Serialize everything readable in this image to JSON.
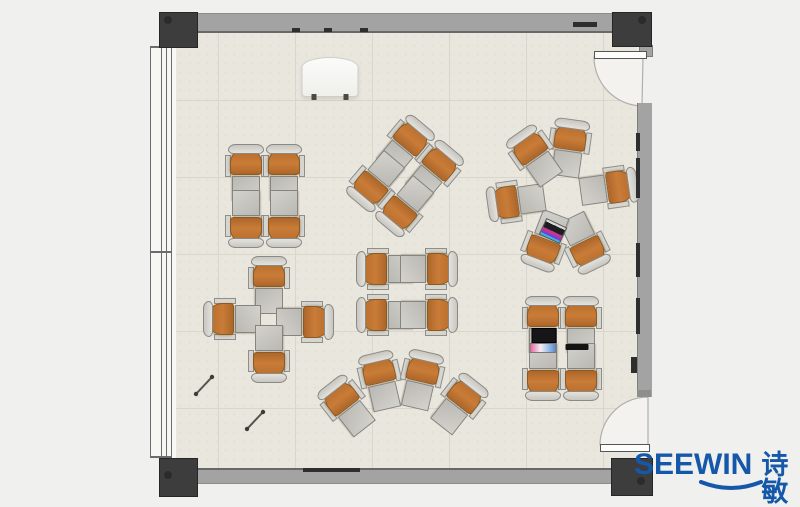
{
  "brand": {
    "name_en": "SEEWIN",
    "name_cn": "诗敏",
    "color": "#1557a8"
  },
  "plan": {
    "description": "classroom-floor-plan-top-view",
    "colors": {
      "background": "#f0f0ef",
      "floor": "#e9e6dd",
      "grid": "#d9d6cb",
      "wall": "#a3a3a3",
      "column": "#3d3d3d",
      "chair_seat": "#c97c38",
      "desk_top": "#c6c5c0",
      "brand": "#1557a8"
    },
    "furniture": {
      "unit_count": 30,
      "clusters": [
        {
          "name": "quad-top-left",
          "units": [
            {
              "x": 246,
              "y": 173,
              "rot": 180
            },
            {
              "x": 284,
              "y": 173,
              "rot": 180
            },
            {
              "x": 246,
              "y": 219,
              "rot": 0
            },
            {
              "x": 284,
              "y": 219,
              "rot": 0
            }
          ]
        },
        {
          "name": "quad-rotated-mid",
          "units": [
            {
              "x": 405,
              "y": 146,
              "rot": 220
            },
            {
              "x": 434,
              "y": 171,
              "rot": 220
            },
            {
              "x": 376,
              "y": 181,
              "rot": 40
            },
            {
              "x": 405,
              "y": 206,
              "rot": 40
            }
          ]
        },
        {
          "name": "circle-right",
          "units": [
            {
              "x": 569,
              "y": 148,
              "rot": 188
            },
            {
              "x": 609,
              "y": 188,
              "rot": 262
            },
            {
              "x": 584,
              "y": 243,
              "rot": 334
            },
            {
              "x": 546,
              "y": 241,
              "rot": 21
            },
            {
              "x": 516,
              "y": 201,
              "rot": 82
            },
            {
              "x": 535,
              "y": 156,
              "rot": 145
            }
          ]
        },
        {
          "name": "cross-left",
          "units": [
            {
              "x": 269,
              "y": 285,
              "rot": 180
            },
            {
              "x": 232,
              "y": 319,
              "rot": 90
            },
            {
              "x": 305,
              "y": 322,
              "rot": 270
            },
            {
              "x": 269,
              "y": 354,
              "rot": 0
            }
          ]
        },
        {
          "name": "quad-center",
          "units": [
            {
              "x": 385,
              "y": 269,
              "rot": 90
            },
            {
              "x": 429,
              "y": 269,
              "rot": 270
            },
            {
              "x": 385,
              "y": 315,
              "rot": 90
            },
            {
              "x": 429,
              "y": 315,
              "rot": 270
            }
          ]
        },
        {
          "name": "fan-bottom",
          "units": [
            {
              "x": 347,
              "y": 406,
              "rot": 142
            },
            {
              "x": 381,
              "y": 381,
              "rot": 167
            },
            {
              "x": 421,
              "y": 380,
              "rot": 193
            },
            {
              "x": 459,
              "y": 404,
              "rot": 218
            }
          ]
        },
        {
          "name": "quad-bottom-right",
          "units": [
            {
              "x": 543,
              "y": 325,
              "rot": 180
            },
            {
              "x": 581,
              "y": 325,
              "rot": 180
            },
            {
              "x": 543,
              "y": 372,
              "rot": 0
            },
            {
              "x": 581,
              "y": 372,
              "rot": 0
            }
          ]
        }
      ]
    },
    "items": {
      "podium": {
        "x": 330,
        "y": 77,
        "w": 55,
        "h": 38
      },
      "laptops": [
        {
          "style": "colorful",
          "x": 553,
          "y": 231,
          "w": 21,
          "h": 16,
          "rot": 25
        },
        {
          "style": "screen-keyboard",
          "x": 543,
          "y": 340,
          "w": 27,
          "h": 24,
          "rot": 0
        }
      ],
      "tablet": {
        "x": 577,
        "y": 347,
        "w": 23,
        "h": 6
      },
      "pens": [
        {
          "x1": 196,
          "y1": 394,
          "x2": 212,
          "y2": 377
        },
        {
          "x1": 247,
          "y1": 429,
          "x2": 263,
          "y2": 412
        }
      ]
    }
  }
}
